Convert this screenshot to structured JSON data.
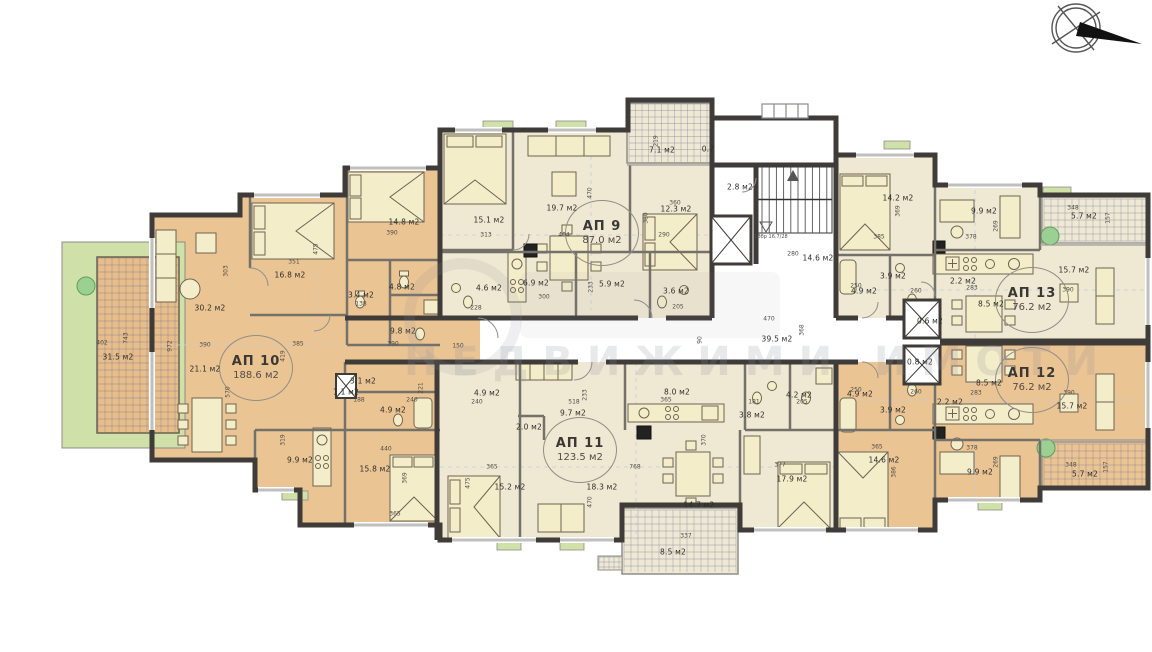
{
  "watermark": {
    "text": "НЕДВИЖИМИ ИМОТИ"
  },
  "stair_note": {
    "text": "18бр 16.7/28",
    "x": 771,
    "y": 237
  },
  "colors": {
    "apartment_orange": "#ebc493",
    "apartment_cream": "#efe8d2",
    "wall_dark": "#3e3b38",
    "partition_gray": "#74706a",
    "furniture_fill": "#f4edca",
    "green_landscape": "#cfe0a8",
    "plant_green": "#9ccf92",
    "terrace_grid": "#5e6696"
  },
  "apartments": [
    {
      "name": "АП 9",
      "area": "87.0 м2",
      "x": 602,
      "y": 233
    },
    {
      "name": "АП 10",
      "area": "188.6 м2",
      "x": 256,
      "y": 368
    },
    {
      "name": "АП 11",
      "area": "123.5 м2",
      "x": 580,
      "y": 450
    },
    {
      "name": "АП 13",
      "area": "76.2 м2",
      "x": 1032,
      "y": 300
    },
    {
      "name": "АП 12",
      "area": "76.2 м2",
      "x": 1032,
      "y": 380
    }
  ],
  "rooms": [
    {
      "t": "30.2 м2",
      "x": 210,
      "y": 308
    },
    {
      "t": "21.1 м2",
      "x": 205,
      "y": 369
    },
    {
      "t": "16.8 м2",
      "x": 290,
      "y": 275
    },
    {
      "t": "14.8 м2",
      "x": 404,
      "y": 222
    },
    {
      "t": "4.8 м2",
      "x": 402,
      "y": 287
    },
    {
      "t": "3.4 м2",
      "x": 361,
      "y": 295
    },
    {
      "t": "9.8 м2",
      "x": 403,
      "y": 331
    },
    {
      "t": "3.1 м2",
      "x": 363,
      "y": 381
    },
    {
      "t": "1.1 м2",
      "x": 346,
      "y": 392
    },
    {
      "t": "4.9 м2",
      "x": 393,
      "y": 410
    },
    {
      "t": "9.9 м2",
      "x": 300,
      "y": 460
    },
    {
      "t": "15.8 м2",
      "x": 375,
      "y": 469
    },
    {
      "t": "31.5 м2",
      "x": 118,
      "y": 357
    },
    {
      "t": "15.1 м2",
      "x": 489,
      "y": 220
    },
    {
      "t": "19.7 м2",
      "x": 562,
      "y": 208
    },
    {
      "t": "12.3 м2",
      "x": 676,
      "y": 209
    },
    {
      "t": "4.6 м2",
      "x": 489,
      "y": 288
    },
    {
      "t": "6.9 м2",
      "x": 536,
      "y": 283
    },
    {
      "t": "5.9 м2",
      "x": 612,
      "y": 284
    },
    {
      "t": "3.6 м2",
      "x": 676,
      "y": 291
    },
    {
      "t": "7.1 м2",
      "x": 662,
      "y": 150
    },
    {
      "t": "0.7",
      "x": 708,
      "y": 149
    },
    {
      "t": "2.8 м2",
      "x": 740,
      "y": 187
    },
    {
      "t": "14.6 м2",
      "x": 818,
      "y": 258
    },
    {
      "t": "39.5 м2",
      "x": 777,
      "y": 339
    },
    {
      "t": "0.6 м2",
      "x": 930,
      "y": 321
    },
    {
      "t": "0.8 м2",
      "x": 920,
      "y": 362
    },
    {
      "t": "4.9 м2",
      "x": 487,
      "y": 393
    },
    {
      "t": "9.7 м2",
      "x": 573,
      "y": 413
    },
    {
      "t": "2.0 м2",
      "x": 529,
      "y": 427
    },
    {
      "t": "15.2 м2",
      "x": 510,
      "y": 487
    },
    {
      "t": "18.3 м2",
      "x": 602,
      "y": 487
    },
    {
      "t": "8.0 м2",
      "x": 677,
      "y": 392
    },
    {
      "t": "14.7 м2",
      "x": 699,
      "y": 505
    },
    {
      "t": "17.9 м2",
      "x": 792,
      "y": 479
    },
    {
      "t": "4.2 м2",
      "x": 799,
      "y": 395
    },
    {
      "t": "3.8 м2",
      "x": 752,
      "y": 415
    },
    {
      "t": "8.5 м2",
      "x": 673,
      "y": 552
    },
    {
      "t": "14.2 м2",
      "x": 898,
      "y": 198
    },
    {
      "t": "3.9 м2",
      "x": 893,
      "y": 276
    },
    {
      "t": "4.9 м2",
      "x": 864,
      "y": 291
    },
    {
      "t": "2.2 м2",
      "x": 963,
      "y": 281
    },
    {
      "t": "8.5 м2",
      "x": 991,
      "y": 304
    },
    {
      "t": "9.9 м2",
      "x": 984,
      "y": 211
    },
    {
      "t": "15.7 м2",
      "x": 1074,
      "y": 270
    },
    {
      "t": "5.7 м2",
      "x": 1084,
      "y": 216
    },
    {
      "t": "3.9 м2",
      "x": 893,
      "y": 410
    },
    {
      "t": "4.9 м2",
      "x": 860,
      "y": 394
    },
    {
      "t": "2.2 м2",
      "x": 950,
      "y": 402
    },
    {
      "t": "8.5 м2",
      "x": 989,
      "y": 383
    },
    {
      "t": "14.6 м2",
      "x": 884,
      "y": 460
    },
    {
      "t": "9.9 м2",
      "x": 980,
      "y": 472
    },
    {
      "t": "15.7 м2",
      "x": 1072,
      "y": 406
    },
    {
      "t": "5.7 м2",
      "x": 1085,
      "y": 474
    }
  ],
  "dims": [
    {
      "t": "351",
      "x": 294,
      "y": 262
    },
    {
      "t": "475",
      "x": 316,
      "y": 249,
      "v": true
    },
    {
      "t": "390",
      "x": 392,
      "y": 233
    },
    {
      "t": "303",
      "x": 226,
      "y": 271,
      "v": true
    },
    {
      "t": "138",
      "x": 361,
      "y": 304
    },
    {
      "t": "390",
      "x": 393,
      "y": 344
    },
    {
      "t": "385",
      "x": 298,
      "y": 344
    },
    {
      "t": "419",
      "x": 283,
      "y": 356,
      "v": true
    },
    {
      "t": "570",
      "x": 228,
      "y": 392,
      "v": true
    },
    {
      "t": "972",
      "x": 170,
      "y": 346,
      "v": true
    },
    {
      "t": "390",
      "x": 205,
      "y": 345
    },
    {
      "t": "188",
      "x": 359,
      "y": 400
    },
    {
      "t": "240",
      "x": 412,
      "y": 400
    },
    {
      "t": "221",
      "x": 421,
      "y": 388,
      "v": true
    },
    {
      "t": "319",
      "x": 283,
      "y": 440,
      "v": true
    },
    {
      "t": "440",
      "x": 386,
      "y": 449
    },
    {
      "t": "365",
      "x": 395,
      "y": 514
    },
    {
      "t": "369",
      "x": 405,
      "y": 478,
      "v": true
    },
    {
      "t": "402",
      "x": 102,
      "y": 343
    },
    {
      "t": "743",
      "x": 126,
      "y": 338,
      "v": true
    },
    {
      "t": "313",
      "x": 486,
      "y": 235
    },
    {
      "t": "404",
      "x": 564,
      "y": 235
    },
    {
      "t": "470",
      "x": 590,
      "y": 193,
      "v": true
    },
    {
      "t": "360",
      "x": 675,
      "y": 203
    },
    {
      "t": "290",
      "x": 664,
      "y": 235
    },
    {
      "t": "380",
      "x": 646,
      "y": 218,
      "v": true
    },
    {
      "t": "300",
      "x": 544,
      "y": 297
    },
    {
      "t": "233",
      "x": 591,
      "y": 287,
      "v": true
    },
    {
      "t": "228",
      "x": 476,
      "y": 308
    },
    {
      "t": "205",
      "x": 678,
      "y": 307
    },
    {
      "t": "150",
      "x": 458,
      "y": 346
    },
    {
      "t": "90",
      "x": 700,
      "y": 340,
      "v": true
    },
    {
      "t": "219",
      "x": 656,
      "y": 141,
      "v": true
    },
    {
      "t": "280",
      "x": 793,
      "y": 254
    },
    {
      "t": "470",
      "x": 769,
      "y": 319
    },
    {
      "t": "368",
      "x": 802,
      "y": 330,
      "v": true
    },
    {
      "t": "385",
      "x": 879,
      "y": 237
    },
    {
      "t": "369",
      "x": 898,
      "y": 211,
      "v": true
    },
    {
      "t": "260",
      "x": 916,
      "y": 291
    },
    {
      "t": "250",
      "x": 856,
      "y": 286
    },
    {
      "t": "283",
      "x": 972,
      "y": 288
    },
    {
      "t": "378",
      "x": 971,
      "y": 237
    },
    {
      "t": "269",
      "x": 996,
      "y": 226,
      "v": true
    },
    {
      "t": "390",
      "x": 1068,
      "y": 290
    },
    {
      "t": "348",
      "x": 1073,
      "y": 208
    },
    {
      "t": "157",
      "x": 1108,
      "y": 218,
      "v": true
    },
    {
      "t": "365",
      "x": 877,
      "y": 447
    },
    {
      "t": "386",
      "x": 894,
      "y": 472,
      "v": true
    },
    {
      "t": "260",
      "x": 916,
      "y": 392
    },
    {
      "t": "250",
      "x": 856,
      "y": 390
    },
    {
      "t": "283",
      "x": 976,
      "y": 393
    },
    {
      "t": "378",
      "x": 972,
      "y": 448
    },
    {
      "t": "269",
      "x": 996,
      "y": 462,
      "v": true
    },
    {
      "t": "390",
      "x": 1069,
      "y": 393
    },
    {
      "t": "348",
      "x": 1071,
      "y": 465
    },
    {
      "t": "157",
      "x": 1106,
      "y": 467,
      "v": true
    },
    {
      "t": "240",
      "x": 477,
      "y": 402
    },
    {
      "t": "518",
      "x": 574,
      "y": 402
    },
    {
      "t": "233",
      "x": 585,
      "y": 395,
      "v": true
    },
    {
      "t": "365",
      "x": 492,
      "y": 467
    },
    {
      "t": "475",
      "x": 468,
      "y": 483,
      "v": true
    },
    {
      "t": "470",
      "x": 590,
      "y": 502,
      "v": true
    },
    {
      "t": "768",
      "x": 635,
      "y": 467
    },
    {
      "t": "370",
      "x": 704,
      "y": 440,
      "v": true
    },
    {
      "t": "365",
      "x": 666,
      "y": 400
    },
    {
      "t": "205",
      "x": 802,
      "y": 402
    },
    {
      "t": "181",
      "x": 754,
      "y": 402
    },
    {
      "t": "377",
      "x": 780,
      "y": 465
    },
    {
      "t": "337",
      "x": 686,
      "y": 536
    }
  ]
}
